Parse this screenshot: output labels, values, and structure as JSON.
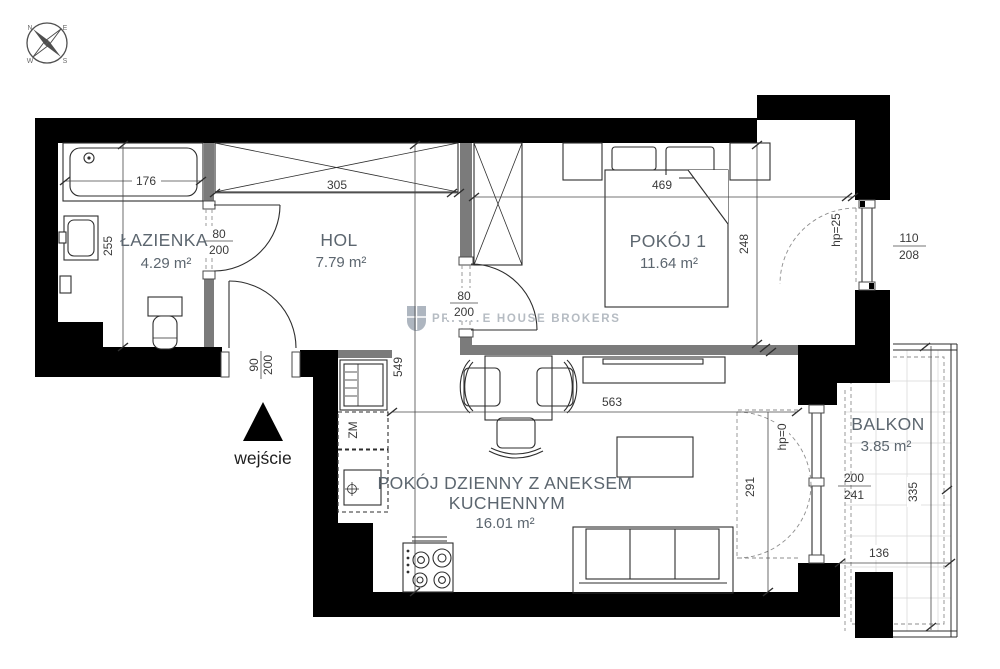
{
  "rooms": {
    "bathroom": {
      "name": "ŁAZIENKA",
      "area": "4.29 m²"
    },
    "hall": {
      "name": "HOL",
      "area": "7.79 m²"
    },
    "room1": {
      "name": "POKÓJ 1",
      "area": "11.64 m²"
    },
    "living": {
      "line1": "POKÓJ DZIENNY Z ANEKSEM",
      "line2": "KUCHENNYM",
      "area": "16.01 m²"
    },
    "balcony": {
      "name": "BALKON",
      "area": "3.85 m²"
    }
  },
  "dims": {
    "tub": "176",
    "bath_depth": "255",
    "hall_width": "305",
    "run": "549",
    "room1_width": "469",
    "room1_depth": "248",
    "living_width": "563",
    "living_depth": "291",
    "balcony_len": "335",
    "balcony_wid": "136"
  },
  "openings": {
    "bath": {
      "w": "80",
      "h": "200"
    },
    "room1": {
      "w": "80",
      "h": "200"
    },
    "entrance": {
      "w": "90",
      "h": "200"
    },
    "window": {
      "w": "110",
      "h": "208",
      "sill": "hp=25"
    },
    "balcony": {
      "w": "200",
      "h": "241",
      "sill": "hp=0"
    }
  },
  "labels": {
    "entrance": "wejście",
    "dishwasher": "ZM"
  },
  "compass": {
    "n": "N",
    "e": "E",
    "s": "S",
    "w": "W"
  },
  "watermark": {
    "brand": "PRIVATE HOUSE BROKERS"
  }
}
